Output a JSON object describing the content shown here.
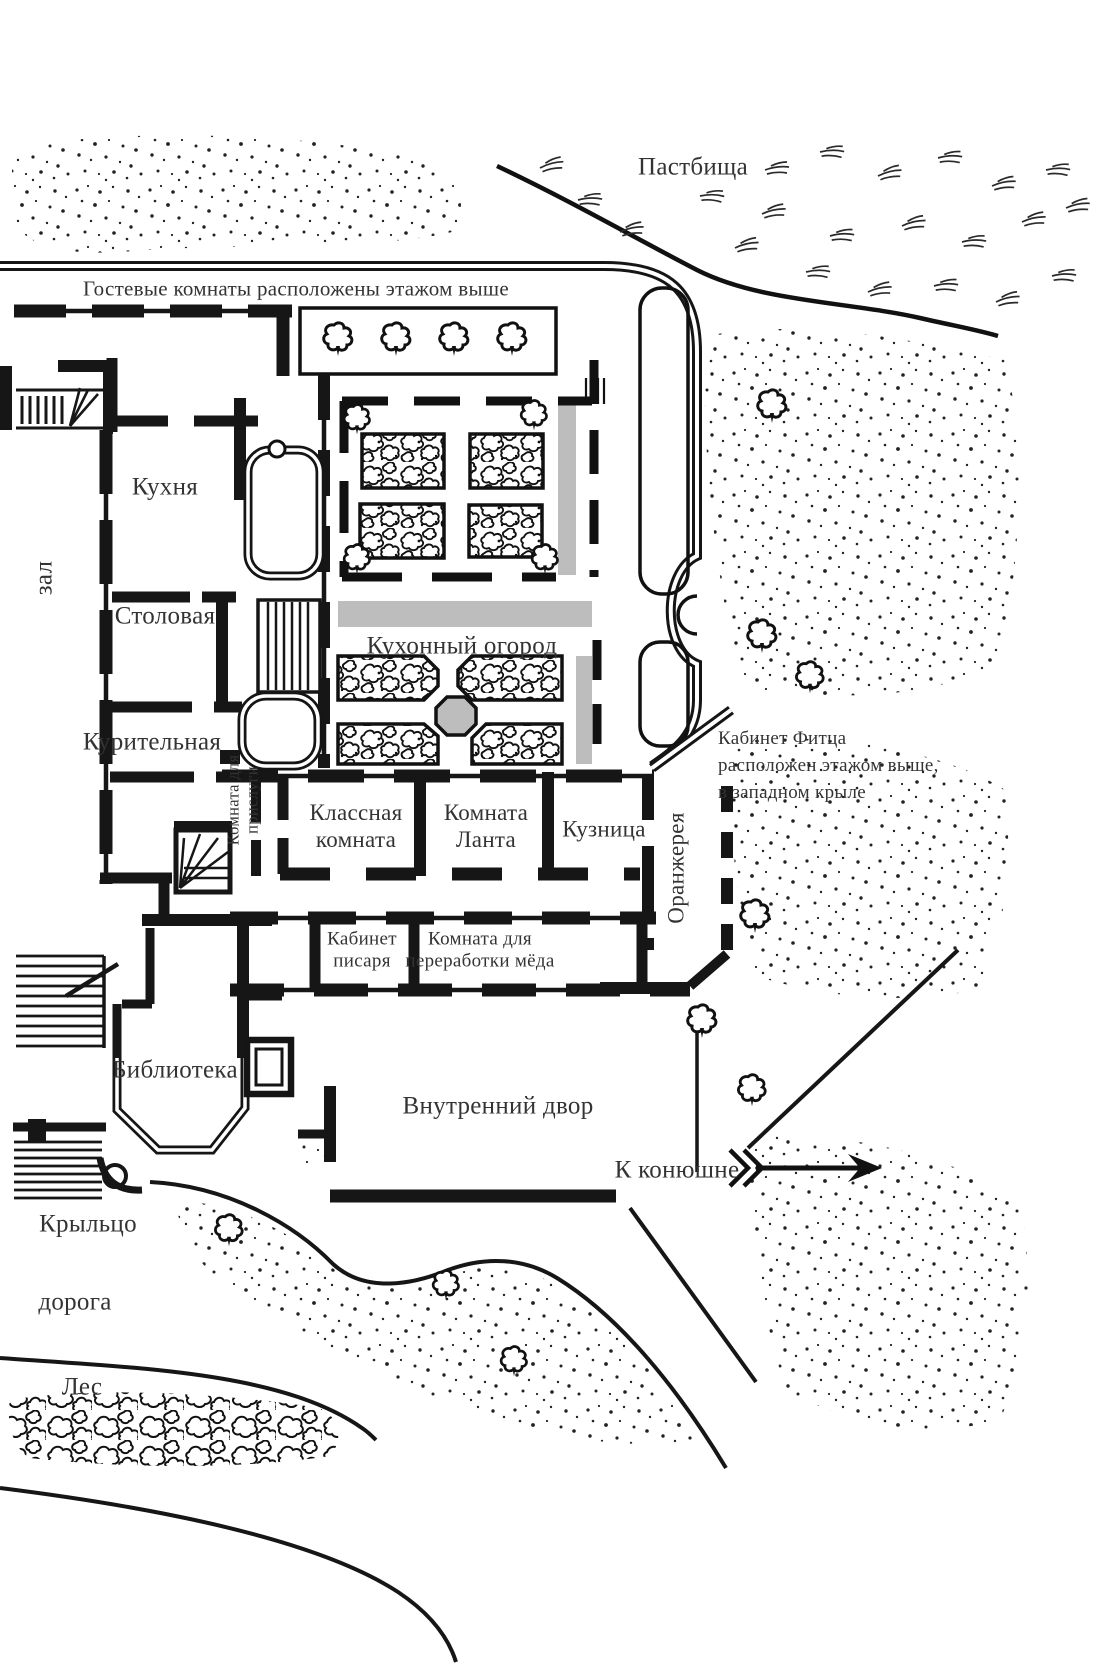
{
  "map": {
    "region_labels": {
      "pastures": {
        "text": "Пастбища"
      },
      "guest_note": {
        "text": "Гостевые комнаты расположены этажом выше"
      },
      "hall": {
        "text": "зал"
      },
      "kitchen": {
        "text": "Кухня"
      },
      "dining": {
        "text": "Столовая"
      },
      "smoking": {
        "text": "Курительная"
      },
      "kitchen_garden": {
        "text": "Кухонный огород"
      },
      "fitz_note": {
        "text": "Кабинет Фитца\nрасположен этажом выше,\nв западном крыле"
      },
      "servants_room": {
        "text": "Комната для\nприслуги"
      },
      "classroom": {
        "text": "Классная\nкомната"
      },
      "lant_room": {
        "text": "Комната\nЛанта"
      },
      "forge": {
        "text": "Кузница"
      },
      "orangery": {
        "text": "Оранжерея"
      },
      "scribe_study": {
        "text": "Кабинет\nписаря"
      },
      "honey_room": {
        "text": "Комната для\nпереработки мёда"
      },
      "library": {
        "text": "Библиотека"
      },
      "courtyard": {
        "text": "Внутренний двор"
      },
      "to_stables": {
        "text": "К конюшне"
      },
      "porch": {
        "text": "Крыльцо"
      },
      "road": {
        "text": "дорога"
      },
      "forest": {
        "text": "Лес"
      }
    },
    "icons": [
      "tree-icon",
      "shrub-bed",
      "fountain-icon",
      "stair-icon",
      "spiral-stair-icon",
      "stables-arrow-icon",
      "fence-line",
      "grass-tuft-icon"
    ],
    "colors": {
      "ink": "#161616",
      "label_ink": "#333333",
      "path_gray": "#bdbdbd",
      "background": "#ffffff"
    }
  }
}
